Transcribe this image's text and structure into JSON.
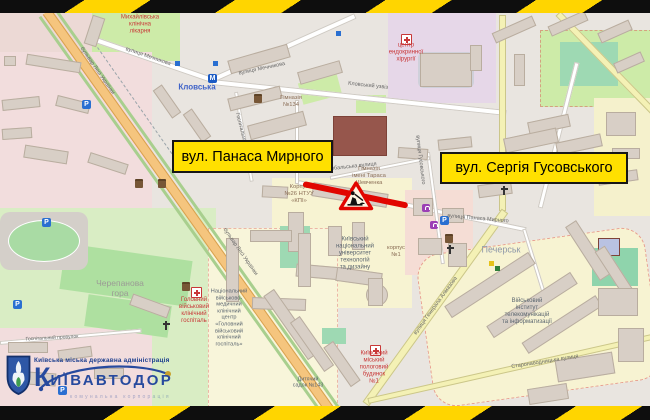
{
  "banner_labels": {
    "left": "вул. Панаса Мирного",
    "right": "вул. Сергія Гусовського"
  },
  "logo": {
    "admin": "Київська міська державна адміністрація",
    "brand_initial": "К",
    "brand_rest": "ИЇВАВТОДОР",
    "subtitle": "комунальна корпорація"
  },
  "icons": {
    "parking_glyph": "P",
    "metro_glyph": "M"
  },
  "colors": {
    "hazard_yellow": "#ffd500",
    "hazard_black": "#0e0e0e",
    "closure_red": "#e10600",
    "banner_yellow": "#ffe000",
    "brand_blue": "#274a9e",
    "map_base": "#e9e5e0"
  },
  "map": {
    "labels": [
      {
        "text": "Михайлівська\nклінічна\nлікарня"
      },
      {
        "text": "Кловська"
      },
      {
        "text": "центр\nендокринної\nхірургії"
      },
      {
        "text": "Гімназія\n№134"
      },
      {
        "text": "Кловський узвіз"
      },
      {
        "text": "вулиця Мечникова"
      },
      {
        "text": "вулиця Мечникова"
      },
      {
        "text": "Черепанова\nгора"
      },
      {
        "text": "Головний\nвійськовий\nклінічний\nгоспіталь"
      },
      {
        "text": "Національний\nвійськово-\nмедичний\nклінічний\nцентр\n«Головний\nвійськовий\nклінічний\nгоспіталь»"
      },
      {
        "text": "Київський\nнаціональний\nуніверситет\nтехнологій\nта дизайну"
      },
      {
        "text": "корпус\n№1"
      },
      {
        "text": "Гімназія\nімені Тараса\nШевченка"
      },
      {
        "text": "Корпус\n№26 НТУУ\n«КПІ»"
      },
      {
        "text": "Печерськ"
      },
      {
        "text": "вулиця Панаса Мирного"
      },
      {
        "text": "Військовий\nінститут\nтелекомунікацій\nта інформатизації"
      },
      {
        "text": "Київський\nміський\nпологовий\nбудинок\n№1"
      },
      {
        "text": "Дитячий\nсадок №143"
      },
      {
        "text": "вулиця Генерала Алмазова"
      },
      {
        "text": "Старонаводницька вулиця"
      },
      {
        "text": "бульвар Лесі Українки"
      },
      {
        "text": "бульвар Лесі Українки"
      },
      {
        "text": "вулиця Гусовського"
      },
      {
        "text": "Рибальська вулиця"
      },
      {
        "text": "Госпітальний провулок"
      },
      {
        "text": "Госпітальна вулиця"
      }
    ]
  }
}
